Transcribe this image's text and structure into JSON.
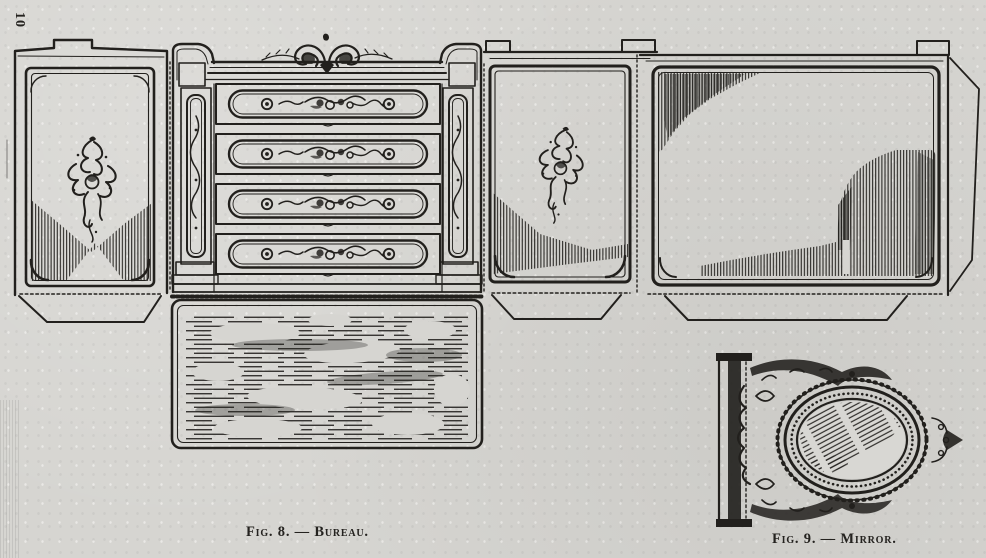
{
  "page": {
    "number": "10",
    "paper_color": "#d6d5d1",
    "ink_color": "#22201d"
  },
  "plate": {
    "description": "Unfolded cut-out paper pattern of a doll's bureau (four drawers, carved side panels, marbled top, back panel with glue tab) and an ornate oval mirror",
    "figures": [
      {
        "id": "fig-8",
        "caption": "Fig. 8. — Bureau.",
        "subject": "bureau"
      },
      {
        "id": "fig-9",
        "caption": "Fig. 9. — Mirror.",
        "subject": "mirror"
      }
    ]
  }
}
